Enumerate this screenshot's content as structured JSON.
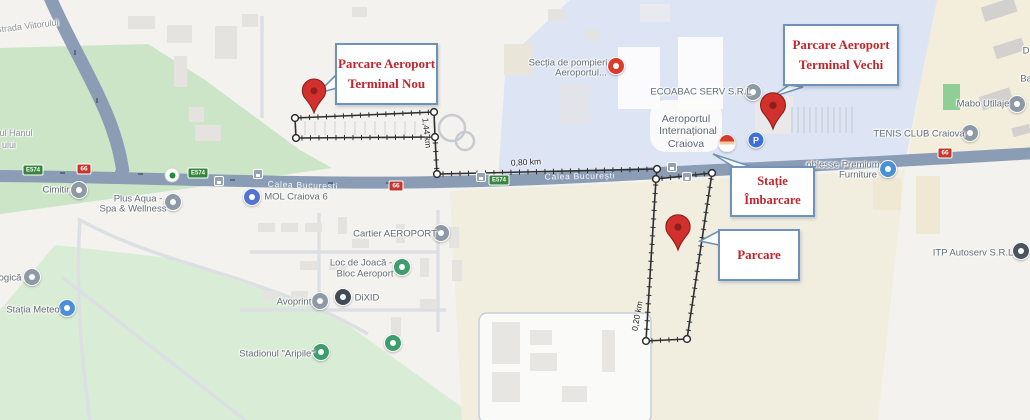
{
  "map": {
    "palette": {
      "road": "#8a9db5",
      "park_green": "#cbe5c6",
      "field_green": "#d9edd6",
      "airport_blue": "#dde4f4",
      "beige": "#f3eddb",
      "cream": "#f1eee0",
      "callout_text_red": "#c0262c",
      "callout_border_blue": "#6f93b8",
      "pin_red": "#d2302c",
      "pin_dark": "#8e1f1c",
      "measure_black": "#2f2f2f",
      "shield_green": "#35853b",
      "shield_red": "#c5362c"
    },
    "street_labels": [
      {
        "id": "strada-viitorului",
        "lines": [
          {
            "t": "Strada Viitorului",
            "x": 27,
            "y": 26
          }
        ],
        "rot": -7
      },
      {
        "id": "hanul-partial",
        "lines": [
          {
            "t": "ul Hanul",
            "x": 16,
            "y": 133
          },
          {
            "t": "ului",
            "x": 9,
            "y": 145
          }
        ],
        "rot": 0
      }
    ],
    "road_labels": [
      {
        "id": "calea-bucuresti-west",
        "text": "Calea București",
        "x": 303,
        "y": 185,
        "rot": 2
      },
      {
        "id": "calea-bucuresti-mid",
        "text": "Calea București",
        "x": 580,
        "y": 176,
        "rot": -1
      }
    ],
    "shields": [
      {
        "kind": "e",
        "text": "E574",
        "x": 33,
        "y": 170
      },
      {
        "kind": "e",
        "text": "E574",
        "x": 198,
        "y": 173
      },
      {
        "kind": "e",
        "text": "E574",
        "x": 499,
        "y": 180
      },
      {
        "kind": "n",
        "text": "66",
        "x": 84,
        "y": 169
      },
      {
        "kind": "n",
        "text": "66",
        "x": 396,
        "y": 186
      },
      {
        "kind": "n",
        "text": "66",
        "x": 945,
        "y": 153
      }
    ],
    "pois": [
      {
        "id": "cimitir",
        "icon": {
          "name": "cemetery-icon",
          "color": "#8d99a5",
          "x": 79,
          "y": 190
        },
        "lines": [
          {
            "t": "Cimitir",
            "x": 56,
            "y": 190
          }
        ]
      },
      {
        "id": "plus-aqua",
        "icon": {
          "name": "spa-icon",
          "color": "#8d99a5",
          "x": 173,
          "y": 202
        },
        "lines": [
          {
            "t": "Plus Aqua -",
            "x": 138,
            "y": 199
          },
          {
            "t": "Spa & Wellness",
            "x": 133,
            "y": 209
          }
        ]
      },
      {
        "id": "mol",
        "icon": {
          "name": "fuel-station-icon",
          "color": "#5472d3",
          "x": 252,
          "y": 197
        },
        "lines": [
          {
            "t": "MOL Craiova 6",
            "x": 296,
            "y": 197
          }
        ]
      },
      {
        "id": "sectia-pompieri",
        "icon": {
          "name": "fire-station-icon",
          "color": "#dd3a2a",
          "x": 616,
          "y": 66
        },
        "lines": [
          {
            "t": "Secția de pompieri",
            "x": 568,
            "y": 63
          },
          {
            "t": "Aeroportul...",
            "x": 581,
            "y": 73
          }
        ]
      },
      {
        "id": "ecoabac",
        "icon": {
          "name": "business-icon",
          "color": "#8d99a5",
          "x": 753,
          "y": 92
        },
        "lines": [
          {
            "t": "ECOABAC SERV S.R.L",
            "x": 701,
            "y": 92
          }
        ]
      },
      {
        "id": "aeroport-craiova",
        "cls": "airport",
        "lines": [
          {
            "t": "Aeroportul",
            "x": 686,
            "y": 119
          },
          {
            "t": "Internațional",
            "x": 688,
            "y": 131
          },
          {
            "t": "Craiova",
            "x": 686,
            "y": 144
          }
        ]
      },
      {
        "id": "mabo-utilaje",
        "icon": {
          "name": "business-icon",
          "color": "#8d99a5",
          "x": 1017,
          "y": 104
        },
        "lines": [
          {
            "t": "Mabo Utilaje",
            "x": 983,
            "y": 104
          }
        ]
      },
      {
        "id": "tenis-club",
        "icon": {
          "name": "tennis-club-icon",
          "color": "#8d99a5",
          "x": 970,
          "y": 133
        },
        "lines": [
          {
            "t": "TENIS CLUB Craiova",
            "x": 919,
            "y": 134
          }
        ]
      },
      {
        "id": "partial-d",
        "lines": [
          {
            "t": "D",
            "x": 1026,
            "y": 51
          }
        ]
      },
      {
        "id": "partial-ba",
        "lines": [
          {
            "t": "Ba",
            "x": 1026,
            "y": 79
          }
        ]
      },
      {
        "id": "noblesse",
        "icon": {
          "name": "shopping-icon",
          "color": "#4a90d9",
          "x": 888,
          "y": 169
        },
        "lines": [
          {
            "t": "oblesse Premium",
            "x": 843,
            "y": 165
          },
          {
            "t": "Furniture",
            "x": 858,
            "y": 175
          }
        ]
      },
      {
        "id": "itp-autoserv",
        "icon": {
          "name": "car-repair-icon",
          "color": "#4a545e",
          "x": 1021,
          "y": 251
        },
        "lines": [
          {
            "t": "ITP Autoserv S.R.L",
            "x": 973,
            "y": 253
          }
        ]
      },
      {
        "id": "cartier-aeroport",
        "icon": {
          "name": "neighborhood-icon",
          "color": "#8d99a5",
          "x": 441,
          "y": 233
        },
        "lines": [
          {
            "t": "Cartier AEROPORT",
            "x": 395,
            "y": 234
          }
        ]
      },
      {
        "id": "loc-de-joaca",
        "icon": {
          "name": "playground-icon",
          "color": "#3d9e6b",
          "x": 402,
          "y": 267
        },
        "lines": [
          {
            "t": "Loc de Joacă -",
            "x": 361,
            "y": 263
          },
          {
            "t": "Bloc Aeroport",
            "x": 365,
            "y": 274
          }
        ]
      },
      {
        "id": "avoprint",
        "icon": {
          "name": "print-shop-icon",
          "color": "#8d99a5",
          "x": 320,
          "y": 301
        },
        "lines": [
          {
            "t": "Avoprint",
            "x": 294,
            "y": 302
          }
        ]
      },
      {
        "id": "dixid",
        "icon": {
          "name": "business-icon",
          "color": "#3f4a56",
          "x": 343,
          "y": 297
        },
        "lines": [
          {
            "t": "DiXID",
            "x": 367,
            "y": 298
          }
        ]
      },
      {
        "id": "stadionul-aripile",
        "icon": {
          "name": "stadium-icon",
          "color": "#3d9e6b",
          "x": 321,
          "y": 352
        },
        "lines": [
          {
            "t": "Stadionul \"Aripile\"",
            "x": 277,
            "y": 354
          }
        ]
      },
      {
        "id": "park-dot",
        "icon": {
          "name": "park-icon",
          "color": "#3d9e6b",
          "x": 393,
          "y": 343
        },
        "lines": []
      },
      {
        "id": "meteorologica-partial",
        "icon": {
          "name": "weather-station-icon",
          "color": "#8d99a5",
          "x": 32,
          "y": 277
        },
        "lines": [
          {
            "t": "ogică",
            "x": 10,
            "y": 278
          }
        ]
      },
      {
        "id": "statia-meteo",
        "icon": {
          "name": "meteo-icon",
          "color": "#4a90d9",
          "x": 67,
          "y": 308
        },
        "lines": [
          {
            "t": "Stația Meteo",
            "x": 33,
            "y": 310
          }
        ]
      }
    ],
    "small_icons": [
      {
        "type": "bus-stop-icon",
        "x": 219,
        "y": 181
      },
      {
        "type": "bus-stop-icon",
        "x": 258,
        "y": 174
      },
      {
        "type": "bus-stop-icon",
        "x": 481,
        "y": 177
      },
      {
        "type": "bus-stop-icon",
        "x": 672,
        "y": 167
      },
      {
        "type": "bus-stop-icon",
        "x": 687,
        "y": 177
      },
      {
        "type": "pedestrian-crossing-icon",
        "x": 172,
        "y": 175
      },
      {
        "type": "parking-icon",
        "x": 756,
        "y": 140,
        "label": "P"
      },
      {
        "type": "santa-icon",
        "x": 727,
        "y": 143
      }
    ],
    "measurements": [
      {
        "text": "1,44 km",
        "x": 427,
        "y": 133,
        "rot": 84
      },
      {
        "text": "0,80 km",
        "x": 526,
        "y": 162,
        "rot": -3
      },
      {
        "text": "0,20 km",
        "x": 637,
        "y": 316,
        "rot": -80
      }
    ],
    "measure_path": {
      "segments": [
        {
          "a": [
            295,
            118
          ],
          "b": [
            434,
            112
          ],
          "ticks": true
        },
        {
          "a": [
            434,
            112
          ],
          "b": [
            435,
            137
          ],
          "ticks": false
        },
        {
          "a": [
            296,
            138
          ],
          "b": [
            435,
            137
          ],
          "ticks": true
        },
        {
          "a": [
            295,
            118
          ],
          "b": [
            296,
            138
          ],
          "ticks": false
        },
        {
          "a": [
            435,
            137
          ],
          "b": [
            437,
            174
          ],
          "ticks": true
        },
        {
          "a": [
            437,
            174
          ],
          "b": [
            657,
            169
          ],
          "ticks": true
        },
        {
          "a": [
            657,
            169
          ],
          "b": [
            656,
            179
          ],
          "ticks": false
        },
        {
          "a": [
            656,
            179
          ],
          "b": [
            712,
            173
          ],
          "ticks": true
        },
        {
          "a": [
            656,
            179
          ],
          "b": [
            646,
            341
          ],
          "ticks": true
        },
        {
          "a": [
            712,
            173
          ],
          "b": [
            687,
            339
          ],
          "ticks": true
        },
        {
          "a": [
            646,
            341
          ],
          "b": [
            687,
            339
          ],
          "ticks": true
        }
      ],
      "vertices": [
        [
          295,
          118
        ],
        [
          434,
          112
        ],
        [
          435,
          137
        ],
        [
          296,
          138
        ],
        [
          437,
          174
        ],
        [
          657,
          169
        ],
        [
          656,
          179
        ],
        [
          712,
          173
        ],
        [
          646,
          341
        ],
        [
          687,
          339
        ]
      ]
    },
    "pins": [
      {
        "id": "pin-terminal-nou",
        "x": 314,
        "y": 113,
        "s": 1.08
      },
      {
        "id": "pin-terminal-vechi",
        "x": 773,
        "y": 129,
        "s": 1.15
      },
      {
        "id": "pin-parcare",
        "x": 678,
        "y": 250,
        "s": 1.12
      }
    ],
    "callouts": [
      {
        "id": "callout-terminal-nou",
        "x": 335,
        "y": 43,
        "w": 103,
        "h": 62,
        "fs": 13,
        "lines": [
          "Parcare Aeroport",
          "Terminal Nou"
        ],
        "pointer": "337,74 318,93 337,88"
      },
      {
        "id": "callout-terminal-vechi",
        "x": 783,
        "y": 24,
        "w": 116,
        "h": 62,
        "fs": 13,
        "lines": [
          "Parcare Aeroport",
          "Terminal Vechi"
        ],
        "pointer": "789,85 772,97 803,87"
      },
      {
        "id": "callout-statie-imbarcare",
        "x": 730,
        "y": 166,
        "w": 85,
        "h": 51,
        "fs": 12.5,
        "lines": [
          "Stație",
          "Îmbarcare"
        ],
        "pointer": "734,167 713,154 752,167"
      },
      {
        "id": "callout-parcare",
        "x": 718,
        "y": 229,
        "w": 82,
        "h": 52,
        "fs": 13,
        "lines": [
          "Parcare"
        ],
        "pointer": "719,231 700,241 719,245"
      }
    ]
  }
}
